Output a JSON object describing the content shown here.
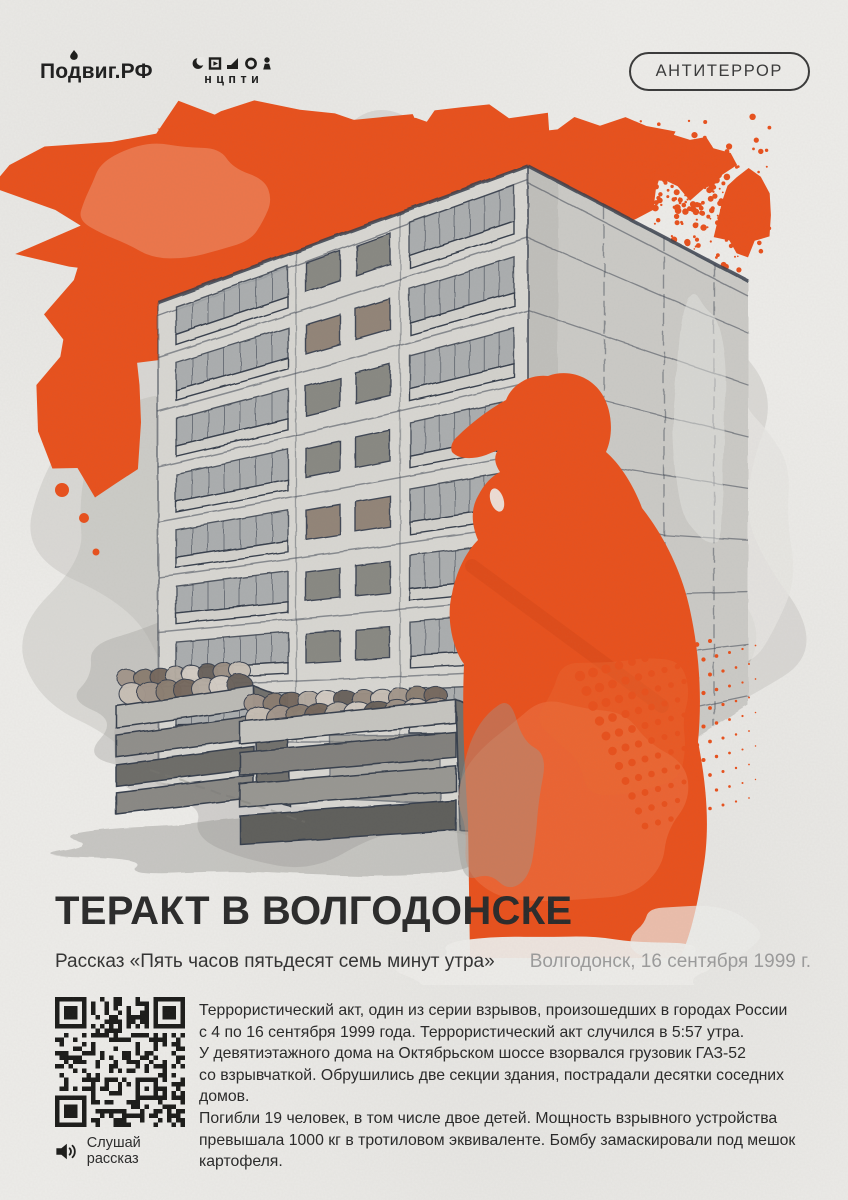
{
  "header": {
    "podvig": "Подвиг.РФ",
    "ncpti": "нцпти",
    "badge": "АНТИТЕРРОР"
  },
  "content": {
    "title": "ТЕРАКТ В ВОЛГОДОНСКЕ",
    "subtitle": "Рассказ «Пять часов пятьдесят семь минут утра»",
    "dateline": "Волгодонск, 16 сентября 1999 г.",
    "body": "Террористический акт, один из серии взрывов, произошедших в городах России\nс 4 по 16 сентября 1999 года. Террористический акт случился в 5:57 утра.\nУ девятиэтажного дома на Октябрьском шоссе взорвался грузовик ГАЗ-52\nсо взрывчаткой. Обрушились две секции здания, пострадали десятки соседних домов.\nПогибли 19 человек, в том числе двое детей. Мощность взрывного устройства\nпревышала 1000 кг в тротиловом эквиваленте. Бомбу замаскировали под мешок\nкартофеля.",
    "audio_label": "Слушай рассказ"
  },
  "icons": {
    "brand_mark": "flame-icon",
    "ncpti_glyphs": [
      "crescent-icon",
      "play-square-icon",
      "corner-shape-icon",
      "circle-icon",
      "person-icon"
    ],
    "audio": "speaker-icon",
    "qr": "qr-code"
  },
  "colors": {
    "accent": "#E8511D",
    "ink": "#2B2B2B",
    "muted": "#9B9B9B",
    "paper": "#EDECE9",
    "line": "#39404E"
  }
}
